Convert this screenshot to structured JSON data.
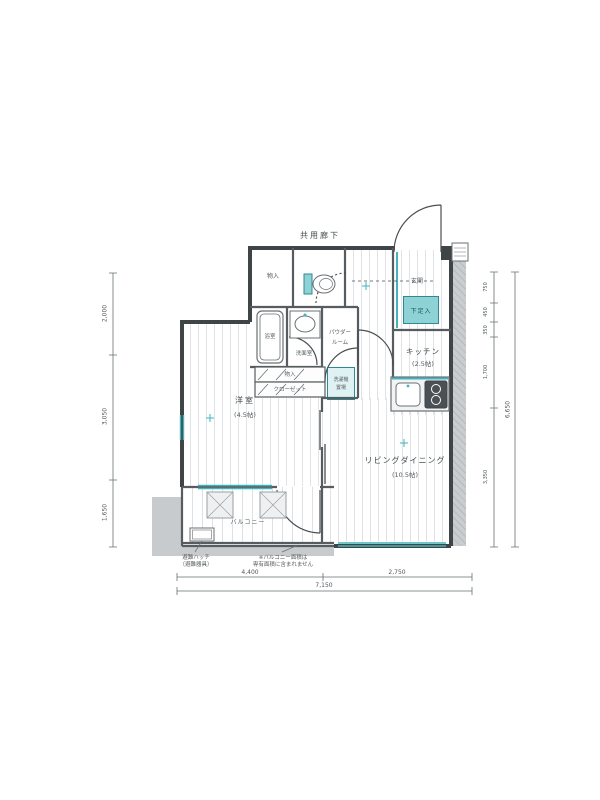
{
  "labels": {
    "corridor": "共用廊下",
    "entrance": "玄関",
    "shoe_box": "下足入",
    "upper_closet": "物入",
    "bath": "浴室",
    "washroom": "洗面室",
    "powder_1": "パウダー",
    "powder_2": "ルーム",
    "washer_1": "洗濯機",
    "washer_2": "置場",
    "storage_band": "物入",
    "closet_band": "クローゼット",
    "bedroom": "洋室",
    "bedroom_size": "(4.5帖)",
    "living": "リビングダイニング",
    "living_size": "(10.5帖)",
    "kitchen": "キッチン",
    "kitchen_size": "(2.5帖)",
    "balcony": "バルコニー",
    "note_hatch_1": "避難ハッチ",
    "note_hatch_2": "（避難器具）",
    "note_balcony_1": "※バルコニー面積は",
    "note_balcony_2": "専有面積に含まれません"
  },
  "dimensions": {
    "bottom_left": "4,400",
    "bottom_right": "2,750",
    "bottom_total": "7,150",
    "left": [
      "2,000",
      "3,050",
      "1,650"
    ],
    "right": [
      "750",
      "450",
      "350",
      "1,700",
      "3,350"
    ],
    "right_total": "6,650"
  },
  "colors": {
    "accent": "#45b3bc",
    "accent_dark": "#2e8a92",
    "wall": "#3f4447",
    "exterior_grey": "#c7cbcd",
    "floor_stripe": "#e0e4e6"
  }
}
